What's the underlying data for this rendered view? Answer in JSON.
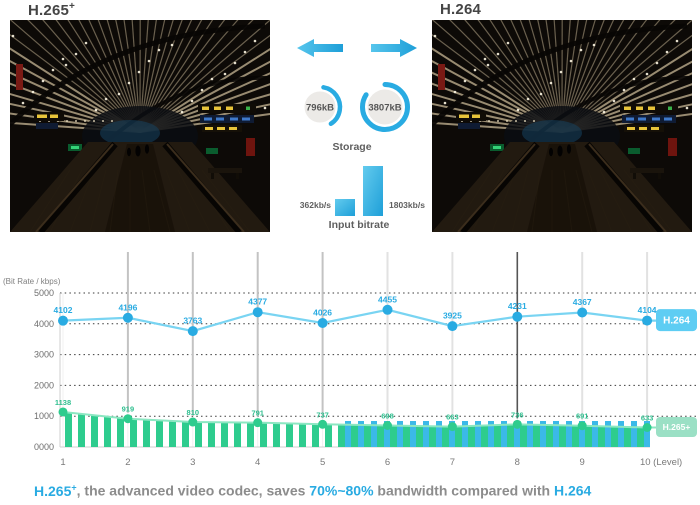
{
  "page": {
    "background": "#ffffff",
    "blue": "#29ABE2",
    "green": "#2ECC8E",
    "gray_text": "#8c8c8c"
  },
  "panels": {
    "left_title": "H.265",
    "left_title_sup": "+",
    "right_title": "H.264"
  },
  "comparison": {
    "storage": {
      "label": "Storage",
      "left_value": "796kB",
      "right_value": "3807kB",
      "left_arc_percent": 38,
      "right_arc_percent": 84
    },
    "input_bitrate": {
      "label": "Input bitrate",
      "left_value": "362kb/s",
      "right_value": "1803kb/s"
    }
  },
  "chart_data": {
    "type": "line",
    "x": [
      1,
      2,
      3,
      4,
      5,
      6,
      7,
      8,
      9,
      10
    ],
    "xlabel": "(Level)",
    "ylabel": "(Bit Rate / kbps)",
    "ytick_labels": [
      "5000",
      "4000",
      "3000",
      "2000",
      "1000",
      "0000"
    ],
    "ylim": [
      0,
      5000
    ],
    "grid": "dotted-horizontal",
    "legend_position": "right-badges",
    "series": [
      {
        "name": "H.264",
        "color": "#29ABE2",
        "line_color": "#79d4f2",
        "values": [
          4102,
          4196,
          3763,
          4377,
          4026,
          4455,
          3925,
          4231,
          4367,
          4104
        ]
      },
      {
        "name": "H.265+",
        "color": "#2ECC8E",
        "line_color": "#8ce7c2",
        "values": [
          1138,
          919,
          810,
          791,
          737,
          698,
          663,
          736,
          691,
          633
        ]
      }
    ]
  },
  "caption": {
    "segments": [
      {
        "text": "H.265",
        "sup": "+",
        "color": "blue"
      },
      {
        "text": ", the advanced video codec, saves ",
        "color": "gray"
      },
      {
        "text": "70%~80%",
        "color": "blue"
      },
      {
        "text": " bandwidth compared with ",
        "color": "gray"
      },
      {
        "text": "H.264",
        "color": "blue"
      }
    ]
  }
}
